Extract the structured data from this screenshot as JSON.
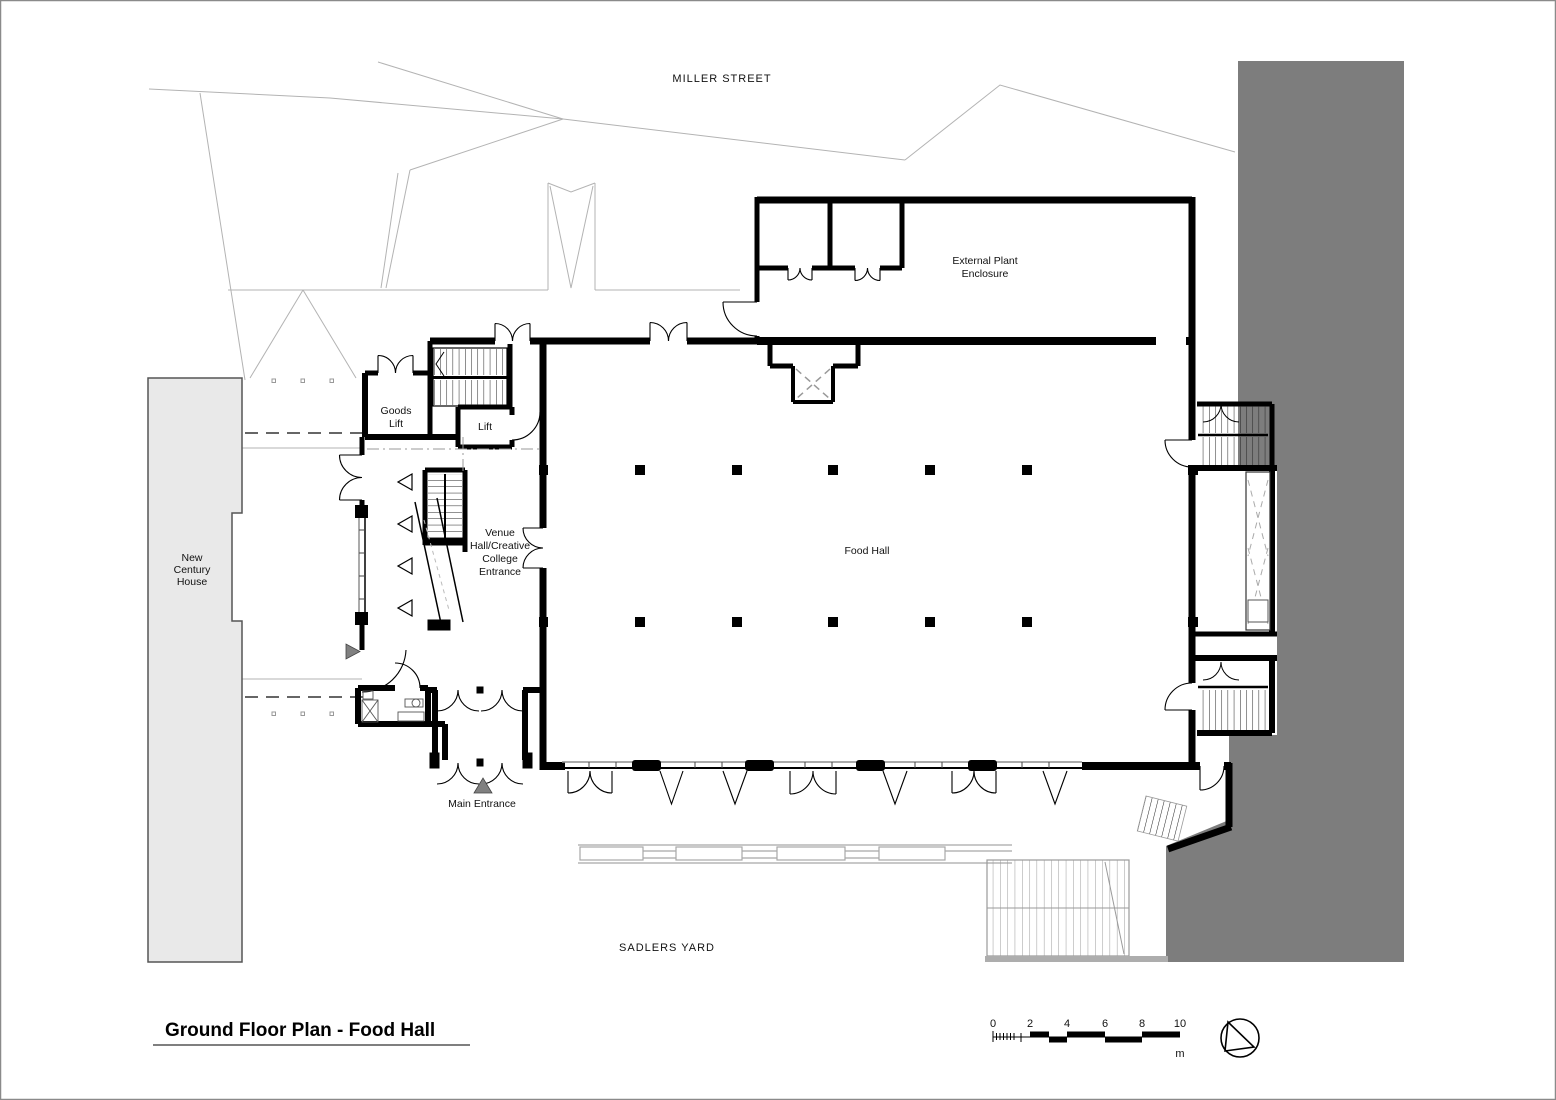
{
  "drawing": {
    "type": "architectural-floor-plan",
    "title_block": {
      "title": "Ground Floor Plan - Food Hall"
    },
    "labels": {
      "miller_street": "MILLER STREET",
      "sadlers_yard": "SADLERS YARD",
      "new_century_house": [
        "New",
        "Century",
        "House"
      ],
      "external_plant": [
        "External Plant",
        "Enclosure"
      ],
      "goods_lift": [
        "Goods",
        "Lift"
      ],
      "lift": "Lift",
      "venue_entrance": [
        "Venue",
        "Hall/Creative",
        "College",
        "Entrance"
      ],
      "food_hall": "Food Hall",
      "main_entrance": "Main Entrance"
    },
    "scale_bar": {
      "ticks": [
        "0",
        "2",
        "4",
        "6",
        "8",
        "10"
      ],
      "unit": "m"
    },
    "icons": {
      "north_arrow": "north-arrow",
      "entrance_marker": "triangle"
    },
    "colors": {
      "walls": "#000000",
      "adjacent_massing": "#7d7d7d",
      "context_building_fill": "#e9e9e9",
      "site_lines": "#b3b3b3",
      "entrance_triangle": "#808080"
    }
  }
}
